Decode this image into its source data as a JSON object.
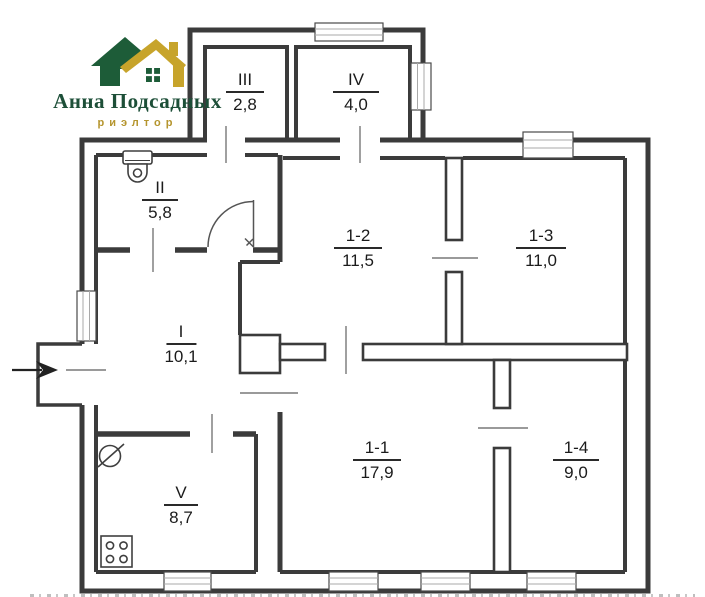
{
  "logo": {
    "title": "Анна Подсадных",
    "subtitle": "риэлтор",
    "title_color": "#1d4f38",
    "subtitle_color": "#b5952e",
    "house_green": "#1d5c38",
    "house_gold": "#c7a42b"
  },
  "plan": {
    "wall_color": "#3b3b3b",
    "entrance": "arrow-into-hall",
    "fixtures": [
      "toilet",
      "sink",
      "stove"
    ],
    "rooms": [
      {
        "id": "I",
        "area": "10,1"
      },
      {
        "id": "II",
        "area": "5,8"
      },
      {
        "id": "III",
        "area": "2,8"
      },
      {
        "id": "IV",
        "area": "4,0"
      },
      {
        "id": "V",
        "area": "8,7"
      },
      {
        "id": "1-1",
        "area": "17,9"
      },
      {
        "id": "1-2",
        "area": "11,5"
      },
      {
        "id": "1-3",
        "area": "11,0"
      },
      {
        "id": "1-4",
        "area": "9,0"
      }
    ]
  }
}
